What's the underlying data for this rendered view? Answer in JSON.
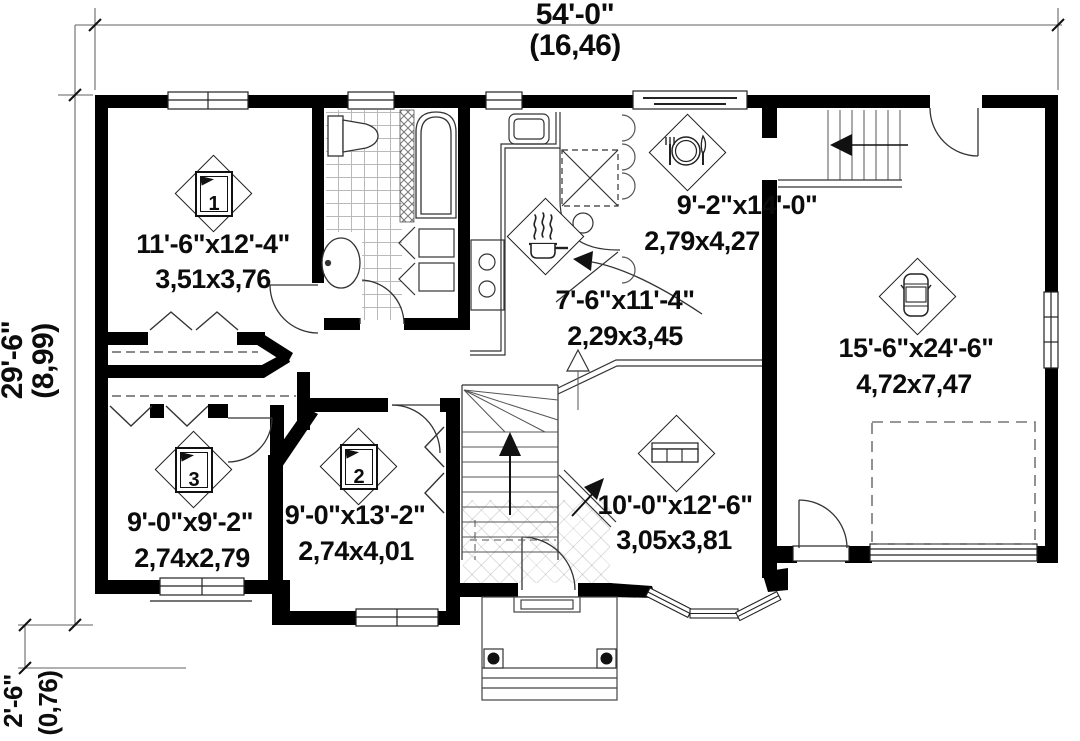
{
  "plan": {
    "title": "single-storey house floor plan",
    "dimensions": {
      "width": {
        "imperial": "54'-0\"",
        "metric": "(16,46)"
      },
      "height": {
        "imperial": "29'-6\"",
        "metric": "(8,99)"
      },
      "porch_offset": {
        "imperial": "2'-6\"",
        "metric": "(0,76)"
      }
    },
    "rooms": [
      {
        "name": "bedroom-1",
        "badge": "1",
        "icon": "bed-icon",
        "imperial": "11'-6\"x12'-4\"",
        "metric": "3,51x3,76"
      },
      {
        "name": "kitchen",
        "icon": "cooking-pot-icon",
        "imperial": "7'-6\"x11'-4\"",
        "metric": "2,29x3,45"
      },
      {
        "name": "dining",
        "icon": "plate-cutlery-icon",
        "imperial": "9'-2\"x14'-0\"",
        "metric": "2,79x4,27"
      },
      {
        "name": "garage",
        "icon": "car-icon",
        "imperial": "15'-6\"x24'-6\"",
        "metric": "4,72x7,47"
      },
      {
        "name": "bedroom-3",
        "badge": "3",
        "icon": "bed-icon",
        "imperial": "9'-0\"x9'-2\"",
        "metric": "2,74x2,79"
      },
      {
        "name": "bedroom-2",
        "badge": "2",
        "icon": "bed-icon",
        "imperial": "9'-0\"x13'-2\"",
        "metric": "2,74x4,01"
      },
      {
        "name": "living",
        "icon": "sofa-icon",
        "imperial": "10'-0\"x12'-6\"",
        "metric": "3,05x3,81"
      }
    ],
    "colors": {
      "wall": "#000000",
      "line": "#1a1a1a",
      "dim_line": "#808080",
      "background": "#ffffff"
    }
  }
}
